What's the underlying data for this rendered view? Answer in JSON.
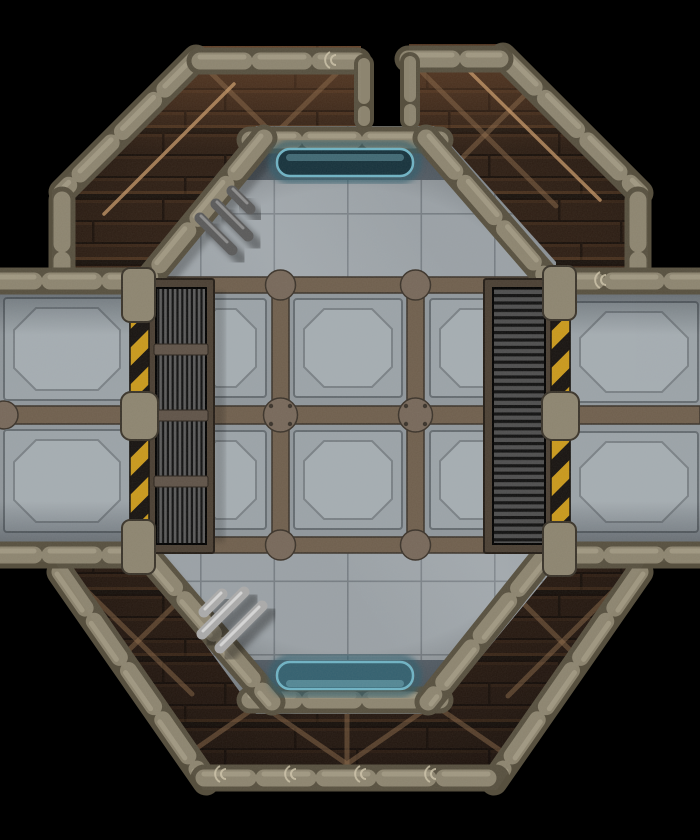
{
  "scene": {
    "description": "Top-down sci-fi RPG battle map tile: an octagonal metal chamber with concrete tile and riveted girder-panel flooring, joined to four diagonal rusted-plank corridors and two side corridors with octagon-inset floor plates; features a vertical-bar vent grate on the west wall, a horizontal-slat vent grate on the east wall, yellow-black hazard strips, glowing blue door lights on the north and south walls, and grey wall pipes, all on a black background",
    "view": "top-down battlemap tile",
    "background": "black"
  },
  "structure": {
    "central_chamber": {
      "shape": "octagon",
      "floor_zones": [
        "plain concrete tiles (north)",
        "girder panel grid 3x2 (center)",
        "plain concrete tiles (south)"
      ],
      "wall_style": "segmented stone-metal capsule beams"
    },
    "corridors": [
      {
        "id": "upper-left",
        "floor": "dark rusted planks with X cross-bracing"
      },
      {
        "id": "upper-right",
        "floor": "dark rusted planks with X cross-bracing"
      },
      {
        "id": "west",
        "floor": "two octagon-inset metal floor panels"
      },
      {
        "id": "east",
        "floor": "two octagon-inset metal floor panels"
      },
      {
        "id": "lower-left",
        "floor": "dark rusted planks with cross-bracing"
      },
      {
        "id": "lower-right",
        "floor": "dark rusted planks with cross-bracing"
      },
      {
        "id": "south-band",
        "floor": "dark rusted planks with truss zigzag bracing"
      }
    ],
    "top_gap": "open black notch between the two upper corridors"
  },
  "features": {
    "vent_grate_left": {
      "bars": "vertical",
      "sections": 4,
      "position": "west side of chamber"
    },
    "vent_grate_right": {
      "bars": "horizontal slats",
      "position": "east side of chamber"
    },
    "hazard_strips": {
      "count": 2,
      "pattern": "diagonal yellow and black",
      "positions": [
        "west, beside left grate",
        "east, beside right grate"
      ],
      "end_caps": "stone pillar caps top, middle and bottom"
    },
    "door_lights": {
      "count": 2,
      "shape": "rounded capsule",
      "positions": [
        "north wall",
        "south wall"
      ],
      "color": "#6fb3c4"
    },
    "pipes": [
      {
        "position": "north-west diagonal wall",
        "count": 3,
        "tone": "dark shadowed"
      },
      {
        "position": "south-west diagonal wall",
        "count": 3,
        "tone": "light metallic"
      }
    ],
    "girder_junctions": {
      "style": "round riveted plates at girder crossings"
    }
  },
  "colors": {
    "bg": "#000000",
    "plank-base": "#281b12",
    "plank-line": "#0d0805",
    "brace": "#8a6847",
    "beam-base": "#57503f",
    "beam-cap": "#8d8570",
    "beam-hi": "#b9b098",
    "girder": "#6f5f4d",
    "girder-dark": "#3b332a",
    "junction": "#77685a",
    "panel": "#9ba3a8",
    "panel-edge": "#656c71",
    "panel-in": "#a5adb2",
    "panel-in-edge": "#7a8186",
    "conc": "#9aa1a6",
    "conc-line": "#767d83",
    "band": "#59636c",
    "floor-mid": "#8f969b",
    "hazard-y": "#c9991c",
    "hazard-k": "#171310",
    "grate-frame": "#4a3f33",
    "grate-bg": "#101010",
    "grate-bar": "#5a5a5a",
    "grate-slat": "#4e4e4e",
    "grate-cross": "#5f5348",
    "blue": "#16323c",
    "blue-edge": "#6fb3c4",
    "blue-glow": "#2e5d6d",
    "pipe-dark": "#5a5a5a",
    "pipe-light": "#aaaaaa",
    "pipe-hi": "#e0e0e0"
  }
}
